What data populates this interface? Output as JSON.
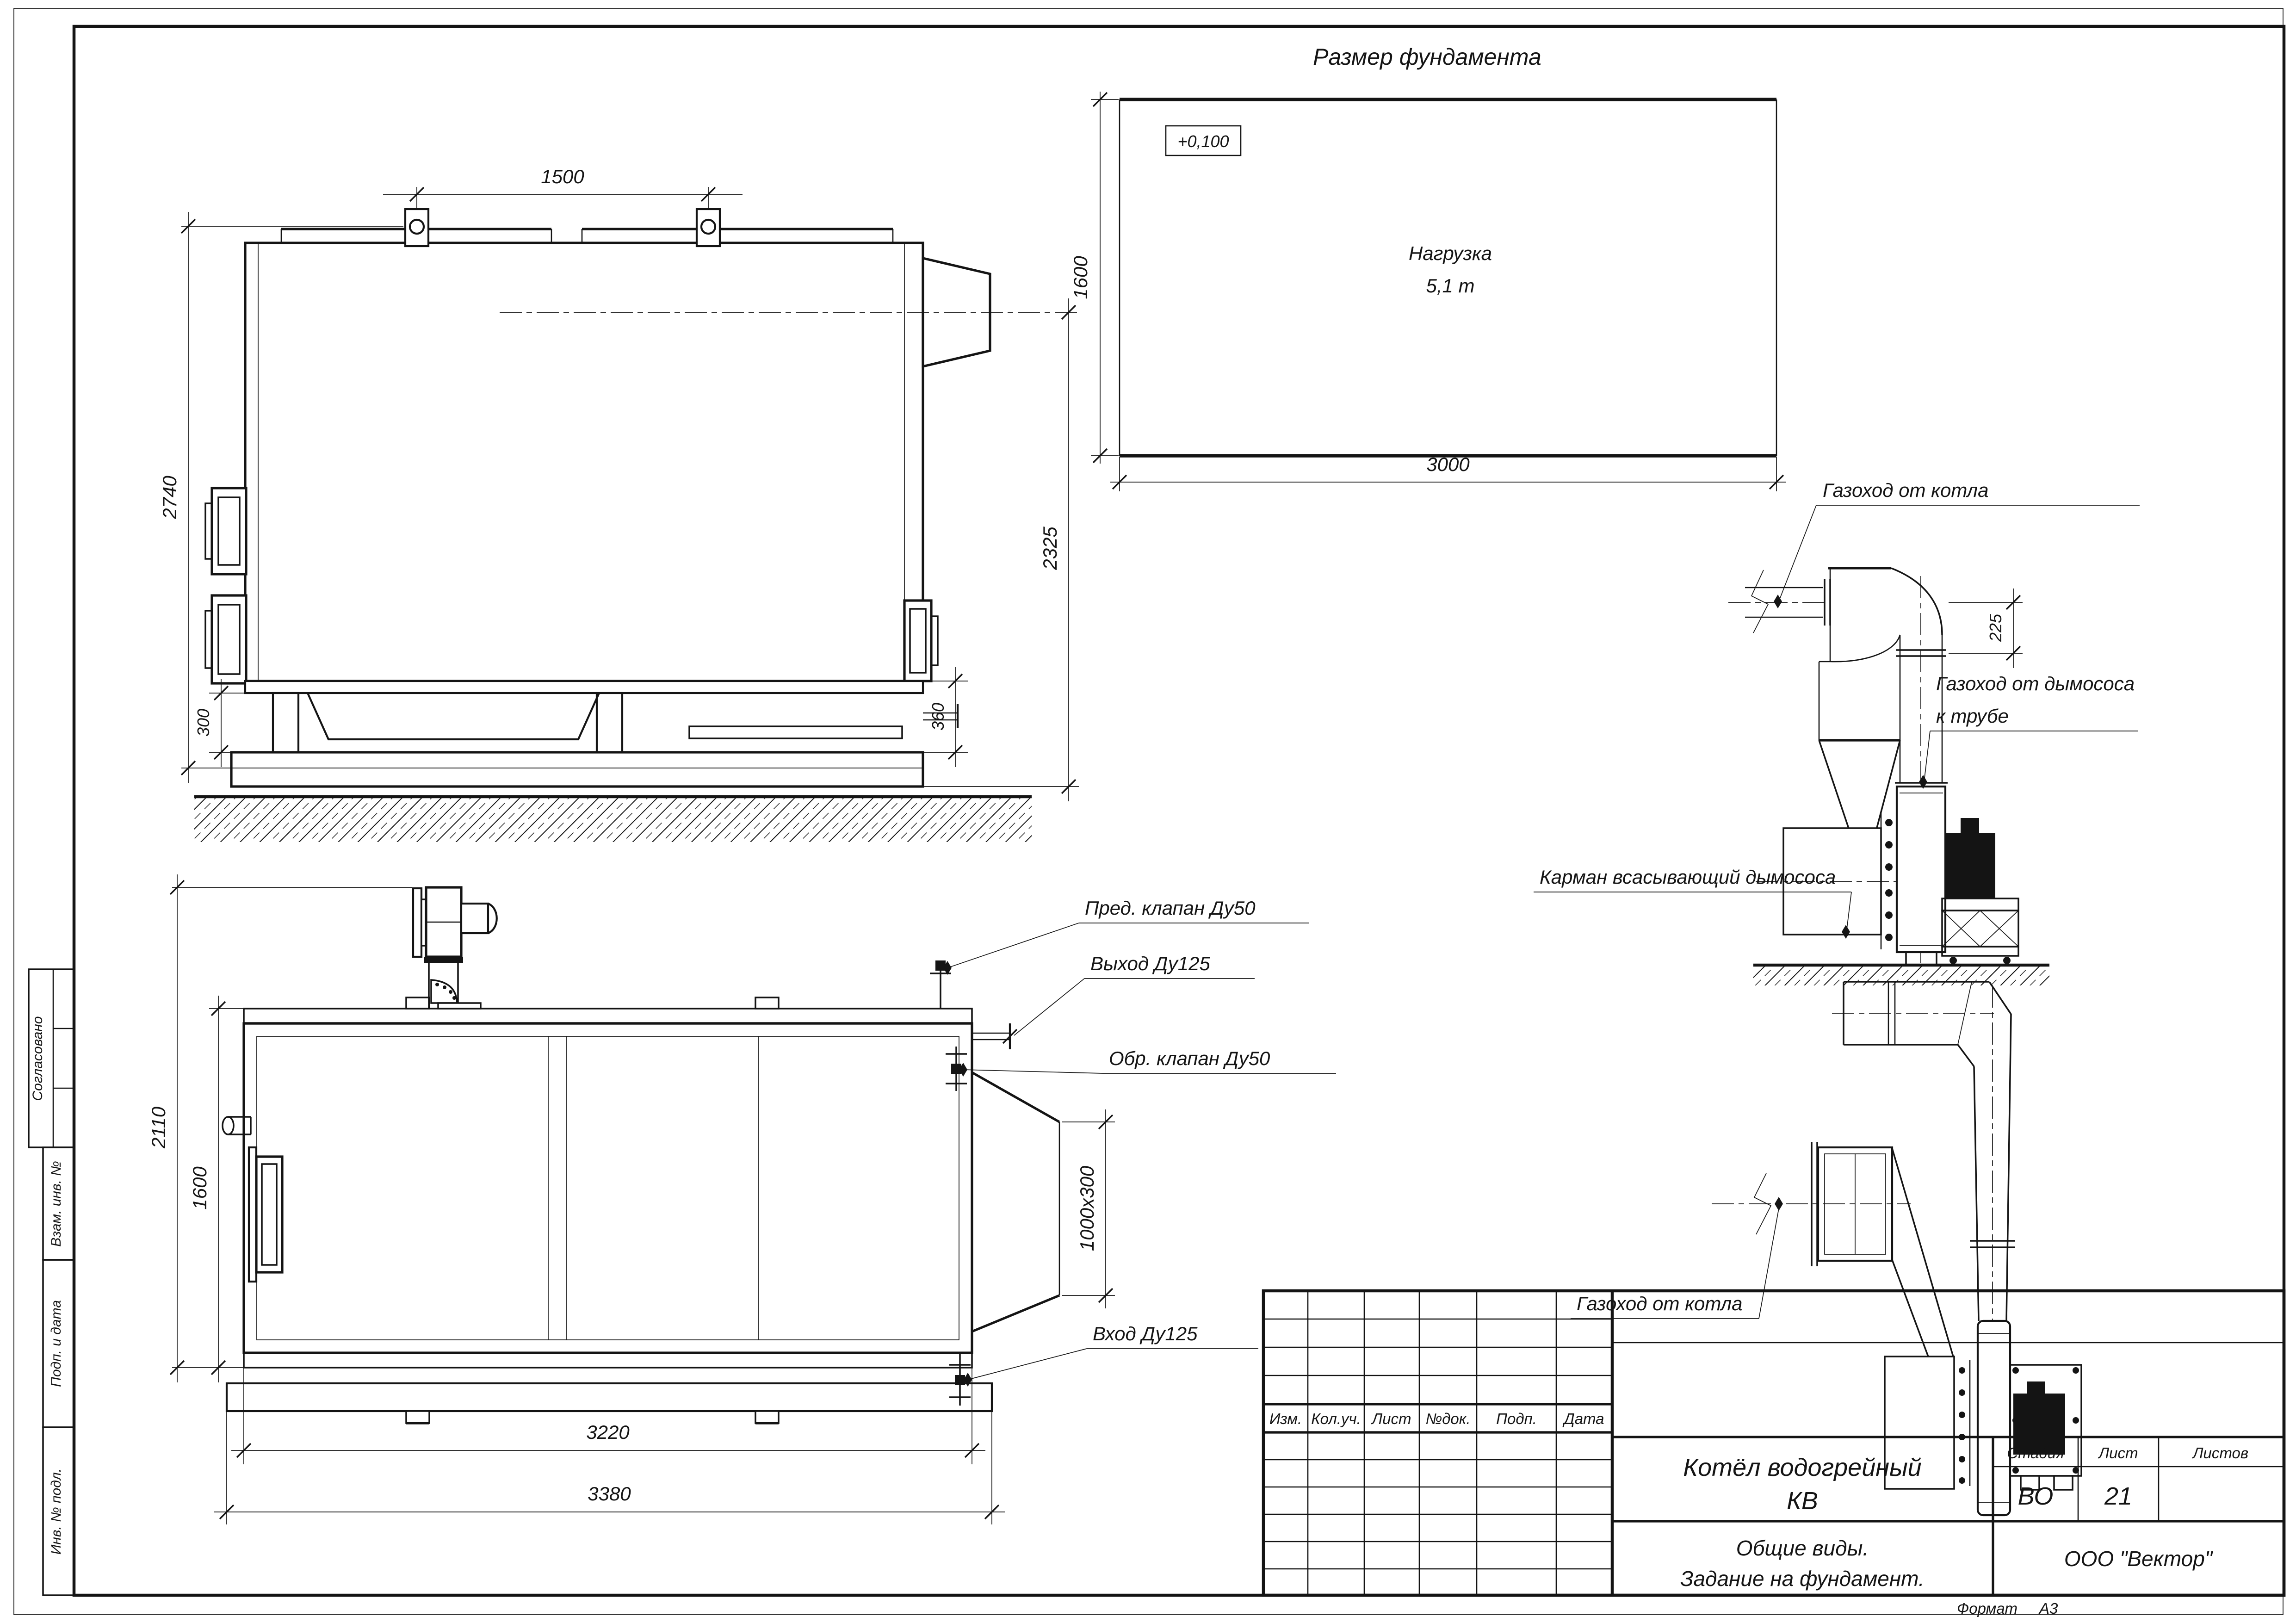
{
  "foundation": {
    "title": "Размер фундамента",
    "elevation": "+0,100",
    "load_line1": "Нагрузка",
    "load_line2": "5,1 т",
    "dim_width": "3000",
    "dim_height": "1600"
  },
  "side_view": {
    "dim_lugs": "1500",
    "dim_height": "2740",
    "dim_flue": "2325",
    "dim_support": "300",
    "dim_rear": "360"
  },
  "plan_view": {
    "dim_overall_width": "2110",
    "dim_body_width": "1600",
    "dim_body_length": "3220",
    "dim_overall_length": "3380",
    "dim_duct": "1000x300",
    "label_safety_valve": "Пред. клапан Ду50",
    "label_outlet": "Выход Ду125",
    "label_check_valve": "Обр. клапан Ду50",
    "label_inlet": "Вход Ду125"
  },
  "duct_side_view": {
    "label_flue_from_boiler": "Газоход от котла",
    "dim_offset": "225",
    "label_flue_to_stack_1": "Газоход от дымососа",
    "label_flue_to_stack_2": "к трубе",
    "label_suction_pocket": "Карман всасывающий дымососа"
  },
  "duct_plan_view": {
    "label_flue_from_boiler": "Газоход от котла"
  },
  "margin_labels": {
    "approved": "Согласовано",
    "replace_inv": "Взам. инв. №",
    "sign_date": "Подп. и дата",
    "inv_orig": "Инв. № подл."
  },
  "title_block": {
    "rev_headers": {
      "izm": "Изм.",
      "koluch": "Кол.уч.",
      "list": "Лист",
      "ndok": "№док.",
      "podp": "Подп.",
      "data": "Дата"
    },
    "product_line1": "Котёл водогрейный",
    "product_line2": "КВ",
    "stage_label": "Стадия",
    "sheet_label": "Лист",
    "sheets_label": "Листов",
    "stage_value": "ВО",
    "sheet_value": "21",
    "doc_line1": "Общие виды.",
    "doc_line2": "Задание на фундамент.",
    "company": "ООО \"Вектор\"",
    "format_label": "Формат",
    "format_value": "А3"
  }
}
